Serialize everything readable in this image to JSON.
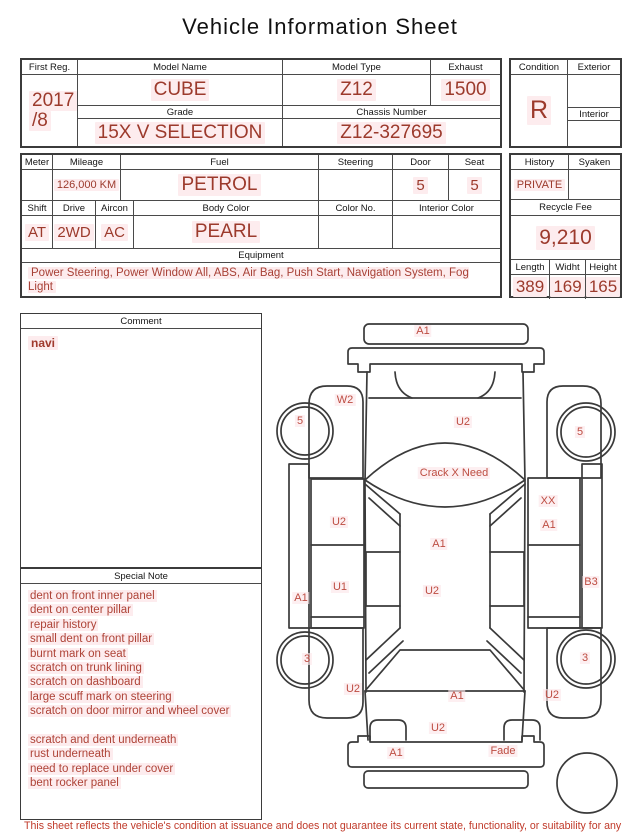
{
  "title": "Vehicle Information Sheet",
  "top_table": {
    "first_reg": {
      "label": "First Reg.",
      "value_line1": "2017",
      "value_line2": "/8"
    },
    "model_name": {
      "label": "Model Name",
      "value": "CUBE"
    },
    "model_type": {
      "label": "Model Type",
      "value": "Z12"
    },
    "exhaust": {
      "label": "Exhaust",
      "value": "1500"
    },
    "grade": {
      "label": "Grade",
      "value": "15X V SELECTION"
    },
    "chassis_number": {
      "label": "Chassis Number",
      "value": "Z12-327695"
    }
  },
  "condition_table": {
    "condition": {
      "label": "Condition",
      "value": "R"
    },
    "exterior": {
      "label": "Exterior",
      "value": ""
    },
    "interior": {
      "label": "Interior",
      "value": ""
    }
  },
  "spec_table": {
    "meter": {
      "label": "Meter",
      "value": ""
    },
    "mileage": {
      "label": "Mileage",
      "value": "126,000 KM"
    },
    "fuel": {
      "label": "Fuel",
      "value": "PETROL"
    },
    "steering": {
      "label": "Steering",
      "value": ""
    },
    "door": {
      "label": "Door",
      "value": "5"
    },
    "seat": {
      "label": "Seat",
      "value": "5"
    },
    "shift": {
      "label": "Shift",
      "value": "AT"
    },
    "drive": {
      "label": "Drive",
      "value": "2WD"
    },
    "aircon": {
      "label": "Aircon",
      "value": "AC"
    },
    "body_color": {
      "label": "Body Color",
      "value": "PEARL"
    },
    "color_no": {
      "label": "Color No.",
      "value": ""
    },
    "interior_color": {
      "label": "Interior Color",
      "value": ""
    },
    "equipment": {
      "label": "Equipment",
      "value": "Power Steering, Power Window All, ABS, Air Bag, Push Start, Navigation System, Fog Light"
    }
  },
  "history_table": {
    "history": {
      "label": "History",
      "value": "PRIVATE"
    },
    "syaken": {
      "label": "Syaken",
      "value": ""
    },
    "recycle_fee": {
      "label": "Recycle Fee",
      "value": "9,210"
    },
    "length": {
      "label": "Length",
      "value": "389"
    },
    "width": {
      "label": "Widht",
      "value": "169"
    },
    "height": {
      "label": "Height",
      "value": "165"
    }
  },
  "comment": {
    "label": "Comment",
    "value": "navi"
  },
  "special_note": {
    "label": "Special Note",
    "lines": [
      "dent on front inner panel",
      "dent on center pillar",
      "repair history",
      "small dent on front pillar",
      "burnt mark on seat",
      "scratch on trunk lining",
      "scratch on dashboard",
      "large scuff mark on steering",
      "scratch on door mirror and wheel cover",
      "",
      "scratch and dent underneath",
      "rust underneath",
      "need to replace under cover",
      "bent rocker panel"
    ]
  },
  "diagram": {
    "labels": [
      {
        "text": "A1",
        "x": 153,
        "y": 21
      },
      {
        "text": "W2",
        "x": 75,
        "y": 90
      },
      {
        "text": "5",
        "x": 30,
        "y": 111
      },
      {
        "text": "5",
        "x": 310,
        "y": 122
      },
      {
        "text": "U2",
        "x": 193,
        "y": 112
      },
      {
        "text": "Crack  X Need",
        "x": 184,
        "y": 163
      },
      {
        "text": "U2",
        "x": 69,
        "y": 212
      },
      {
        "text": "XX",
        "x": 278,
        "y": 191
      },
      {
        "text": "A1",
        "x": 279,
        "y": 215
      },
      {
        "text": "A1",
        "x": 169,
        "y": 234
      },
      {
        "text": "U1",
        "x": 70,
        "y": 277
      },
      {
        "text": "U2",
        "x": 162,
        "y": 281
      },
      {
        "text": "A1",
        "x": 31,
        "y": 288
      },
      {
        "text": "B3",
        "x": 321,
        "y": 272
      },
      {
        "text": "3",
        "x": 37,
        "y": 349
      },
      {
        "text": "3",
        "x": 315,
        "y": 348
      },
      {
        "text": "U2",
        "x": 83,
        "y": 379
      },
      {
        "text": "A1",
        "x": 187,
        "y": 386
      },
      {
        "text": "U2",
        "x": 282,
        "y": 385
      },
      {
        "text": "U2",
        "x": 168,
        "y": 418
      },
      {
        "text": "A1",
        "x": 126,
        "y": 443
      },
      {
        "text": "Fade",
        "x": 233,
        "y": 441
      }
    ]
  },
  "footer": "This sheet reflects the vehicle's condition at issuance and does not guarantee its current state, functionality, or suitability for any purpose",
  "colors": {
    "value_red": "#9c3a2c",
    "note_red": "#ae4337",
    "diagram_label_red": "#bd4c41",
    "footer_red": "#c03a2a",
    "highlight_pink": "#fdecee",
    "border_dark": "#3b3b3b",
    "text_black": "#151515"
  }
}
